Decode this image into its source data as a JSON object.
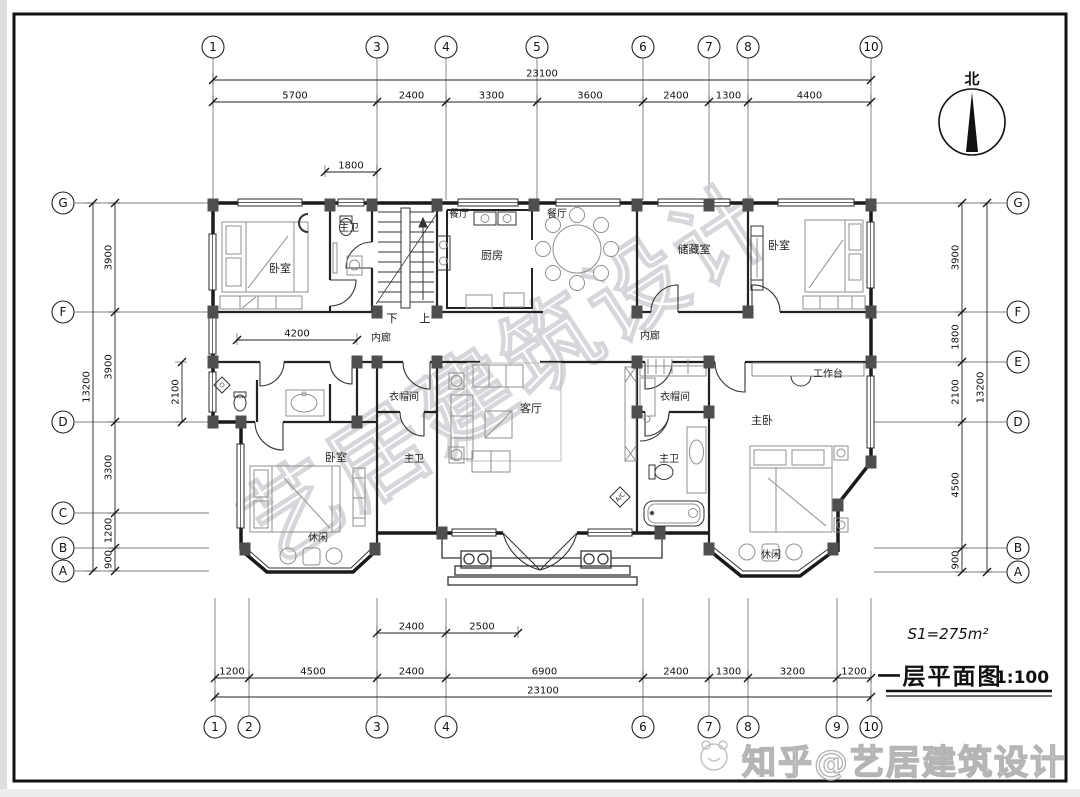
{
  "drawing": {
    "north_label": "北",
    "area_note": "S1=275m²",
    "plan_title": "一层平面图",
    "plan_scale": "1:100",
    "stair_down": "下",
    "stair_up": "上",
    "ac_label": "A/C",
    "watermark_diagonal": "艺居建筑设计",
    "watermark_footer": "知乎@艺居建筑设计"
  },
  "grids": [
    {
      "side": "top",
      "bubble": 47,
      "r": 11,
      "line_a": 58,
      "line_b": 200,
      "items": [
        {
          "label": "1",
          "pos": 213
        },
        {
          "label": "3",
          "pos": 377
        },
        {
          "label": "4",
          "pos": 446
        },
        {
          "label": "5",
          "pos": 537
        },
        {
          "label": "6",
          "pos": 643
        },
        {
          "label": "7",
          "pos": 709
        },
        {
          "label": "8",
          "pos": 748
        },
        {
          "label": "10",
          "pos": 871
        }
      ]
    },
    {
      "side": "bottom",
      "bubble": 727,
      "r": 11,
      "line_a": 598,
      "line_b": 716,
      "items": [
        {
          "label": "1",
          "pos": 215
        },
        {
          "label": "2",
          "pos": 249
        },
        {
          "label": "3",
          "pos": 377
        },
        {
          "label": "4",
          "pos": 446
        },
        {
          "label": "6",
          "pos": 643
        },
        {
          "label": "7",
          "pos": 709
        },
        {
          "label": "8",
          "pos": 748
        },
        {
          "label": "9",
          "pos": 837
        },
        {
          "label": "10",
          "pos": 871
        }
      ]
    },
    {
      "side": "left",
      "bubble": 63,
      "r": 11,
      "line_a": 75,
      "line_b": 209,
      "items": [
        {
          "label": "G",
          "pos": 203
        },
        {
          "label": "F",
          "pos": 312
        },
        {
          "label": "D",
          "pos": 422
        },
        {
          "label": "C",
          "pos": 513
        },
        {
          "label": "B",
          "pos": 548
        },
        {
          "label": "A",
          "pos": 571
        }
      ]
    },
    {
      "side": "right",
      "bubble": 1018,
      "r": 11,
      "line_a": 874,
      "line_b": 1006,
      "items": [
        {
          "label": "G",
          "pos": 203
        },
        {
          "label": "F",
          "pos": 312
        },
        {
          "label": "E",
          "pos": 362
        },
        {
          "label": "D",
          "pos": 422
        },
        {
          "label": "B",
          "pos": 548
        },
        {
          "label": "A",
          "pos": 572
        }
      ]
    }
  ],
  "dim_runs": [
    {
      "dir": "h",
      "pos": 80,
      "ticks": [
        213,
        871
      ],
      "labels": [
        "23100"
      ]
    },
    {
      "dir": "h",
      "pos": 102,
      "ticks": [
        213,
        377,
        446,
        537,
        643,
        709,
        748,
        871
      ],
      "labels": [
        "5700",
        "2400",
        "3300",
        "3600",
        "2400",
        "1300",
        "4400"
      ]
    },
    {
      "dir": "h",
      "pos": 172,
      "ticks": [
        325,
        377
      ],
      "labels": [
        "1800"
      ]
    },
    {
      "dir": "h",
      "pos": 340,
      "ticks": [
        237,
        357
      ],
      "labels": [
        "4200"
      ]
    },
    {
      "dir": "h",
      "pos": 633,
      "ticks": [
        377,
        446,
        518
      ],
      "labels": [
        "2400",
        "2500"
      ]
    },
    {
      "dir": "h",
      "pos": 678,
      "ticks": [
        215,
        249,
        377,
        446,
        643,
        709,
        748,
        837,
        871
      ],
      "labels": [
        "1200",
        "4500",
        "2400",
        "6900",
        "2400",
        "1300",
        "3200",
        "1200"
      ]
    },
    {
      "dir": "h",
      "pos": 697,
      "ticks": [
        215,
        871
      ],
      "labels": [
        "23100"
      ]
    },
    {
      "dir": "v",
      "pos": 93,
      "ticks": [
        203,
        571
      ],
      "labels": [
        "13200"
      ]
    },
    {
      "dir": "v",
      "pos": 115,
      "ticks": [
        203,
        312,
        422,
        513,
        548,
        571
      ],
      "labels": [
        "3900",
        "3900",
        "3300",
        "1200",
        "900"
      ]
    },
    {
      "dir": "v",
      "pos": 182,
      "ticks": [
        362,
        422
      ],
      "labels": [
        "2100"
      ]
    },
    {
      "dir": "v",
      "pos": 962,
      "ticks": [
        203,
        312,
        362,
        422,
        548,
        572
      ],
      "labels": [
        "3900",
        "1800",
        "2100",
        "4500",
        "900"
      ]
    },
    {
      "dir": "v",
      "pos": 987,
      "ticks": [
        203,
        572
      ],
      "labels": [
        "13200"
      ]
    }
  ],
  "room_labels": [
    {
      "text": "卧室",
      "x": 280,
      "y": 272,
      "fs": 11
    },
    {
      "text": "主卫",
      "x": 349,
      "y": 231,
      "fs": 10
    },
    {
      "text": "餐厅",
      "x": 459,
      "y": 217,
      "fs": 10
    },
    {
      "text": "餐厅",
      "x": 557,
      "y": 217,
      "fs": 10
    },
    {
      "text": "厨房",
      "x": 492,
      "y": 259,
      "fs": 11
    },
    {
      "text": "储藏室",
      "x": 694,
      "y": 253,
      "fs": 11
    },
    {
      "text": "卧室",
      "x": 779,
      "y": 249,
      "fs": 11
    },
    {
      "text": "内廊",
      "x": 381,
      "y": 341,
      "fs": 10
    },
    {
      "text": "内廊",
      "x": 650,
      "y": 339,
      "fs": 10
    },
    {
      "text": "衣帽间",
      "x": 404,
      "y": 400,
      "fs": 10
    },
    {
      "text": "客厅",
      "x": 531,
      "y": 412,
      "fs": 11
    },
    {
      "text": "主卫",
      "x": 414,
      "y": 462,
      "fs": 10
    },
    {
      "text": "衣帽间",
      "x": 675,
      "y": 400,
      "fs": 10
    },
    {
      "text": "主卫",
      "x": 669,
      "y": 462,
      "fs": 10
    },
    {
      "text": "主卧",
      "x": 762,
      "y": 424,
      "fs": 11
    },
    {
      "text": "工作台",
      "x": 828,
      "y": 377,
      "fs": 10
    },
    {
      "text": "卧室",
      "x": 336,
      "y": 461,
      "fs": 11
    },
    {
      "text": "休闲",
      "x": 318,
      "y": 541,
      "fs": 10
    },
    {
      "text": "休闲",
      "x": 771,
      "y": 558,
      "fs": 10
    }
  ]
}
